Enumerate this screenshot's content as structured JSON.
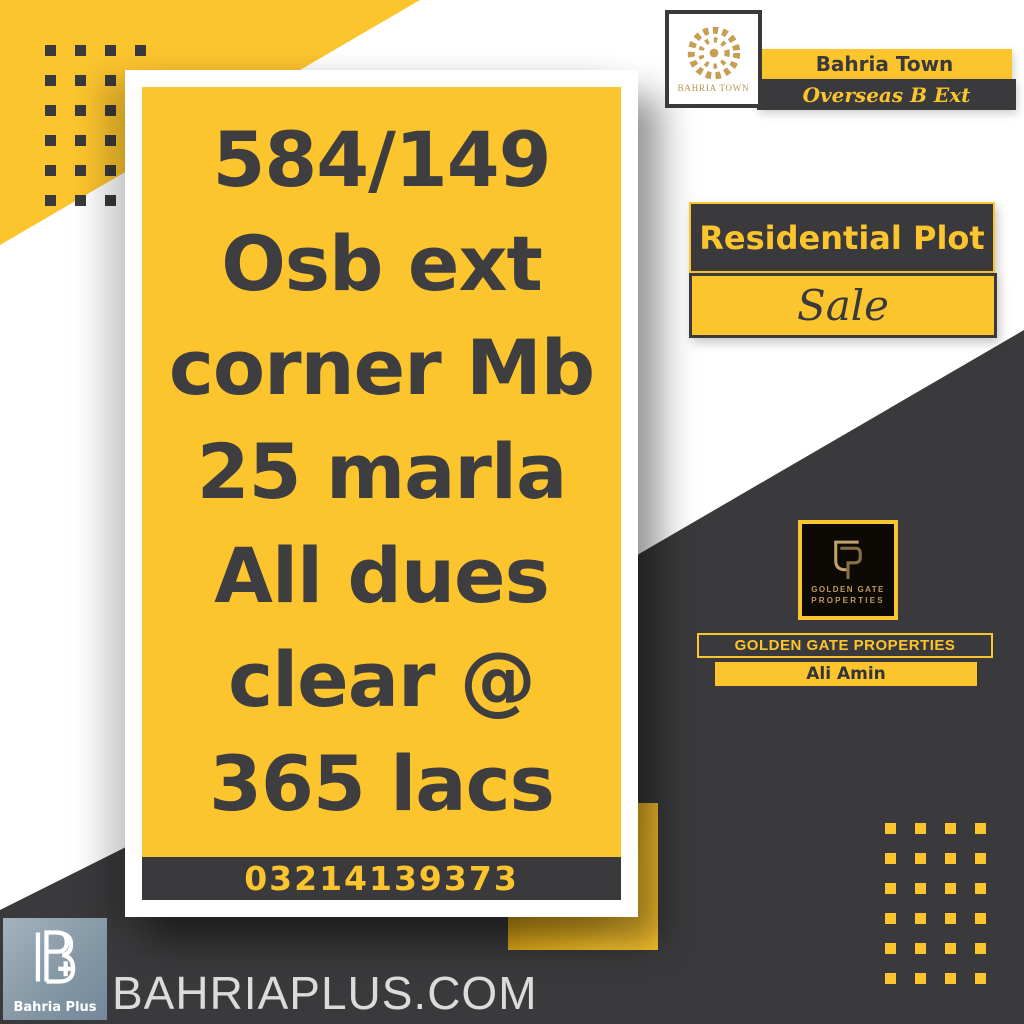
{
  "colors": {
    "accent_yellow": "#FCC42D",
    "dark_charcoal": "#3A3A3C",
    "logo_gold": "#C09A5E",
    "card_text": "#3E3E41",
    "footer_logo_slate": "#8598A6",
    "website_text": "#DBDBDB"
  },
  "header": {
    "logo_label": "BAHRIA TOWN",
    "town_name": "Bahria Town",
    "phase": "Overseas B Ext"
  },
  "listing": {
    "lines": [
      "584/149",
      "Osb ext",
      "corner Mb",
      "25 marla",
      "All dues",
      "clear @",
      "365 lacs"
    ],
    "phone": "03214139373"
  },
  "offer": {
    "type_label": "Residential Plot",
    "status_label": "Sale"
  },
  "agency": {
    "logo_line1": "GOLDEN GATE",
    "logo_line2": "PROPERTIES",
    "bar_label": "GOLDEN GATE PROPERTIES",
    "agent_name": "Ali Amin"
  },
  "footer": {
    "logo_label": "Bahria Plus",
    "website": "BAHRIAPLUS.COM"
  },
  "decor": {
    "dots_rows": 6,
    "dots_cols": 4
  }
}
